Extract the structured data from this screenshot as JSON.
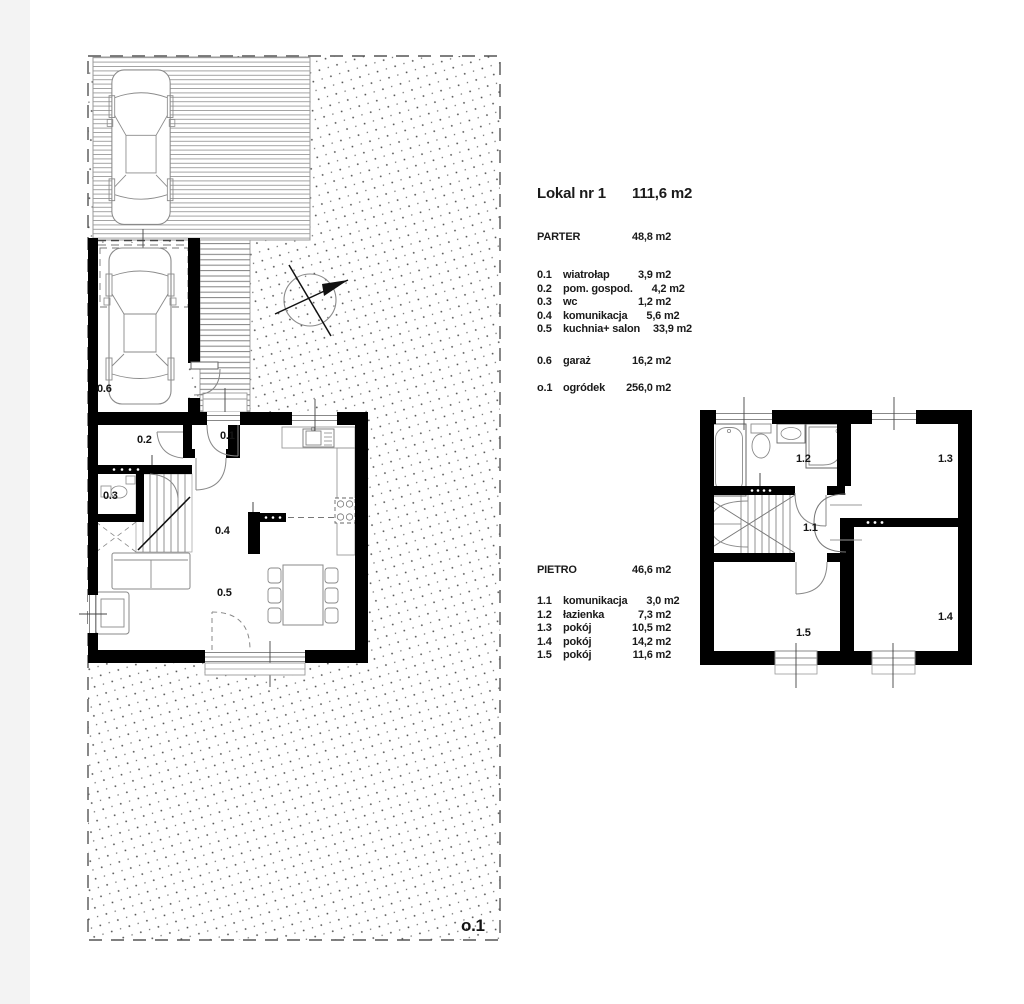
{
  "legend": {
    "title": {
      "name": "Lokal nr 1",
      "area": "111,6 m2"
    },
    "parter": {
      "label": "PARTER",
      "area": "48,8 m2",
      "items": [
        {
          "code": "0.1",
          "name": "wiatrołap",
          "area": "3,9 m2"
        },
        {
          "code": "0.2",
          "name": "pom. gospod.",
          "area": "4,2 m2"
        },
        {
          "code": "0.3",
          "name": "wc",
          "area": "1,2 m2"
        },
        {
          "code": "0.4",
          "name": "komunikacja",
          "area": "5,6 m2"
        },
        {
          "code": "0.5",
          "name": "kuchnia+ salon",
          "area": "33,9 m2"
        }
      ]
    },
    "garage_row": {
      "code": "0.6",
      "name": "garaż",
      "area": "16,2 m2"
    },
    "garden_row": {
      "code": "o.1",
      "name": "ogródek",
      "area": "256,0 m2"
    },
    "pietro": {
      "label": "PIETRO",
      "area": "46,6 m2",
      "items": [
        {
          "code": "1.1",
          "name": "komunikacja",
          "area": "3,0 m2"
        },
        {
          "code": "1.2",
          "name": "łazienka",
          "area": "7,3 m2"
        },
        {
          "code": "1.3",
          "name": "pokój",
          "area": "10,5 m2"
        },
        {
          "code": "1.4",
          "name": "pokój",
          "area": "14,2 m2"
        },
        {
          "code": "1.5",
          "name": "pokój",
          "area": "11,6 m2"
        }
      ]
    }
  },
  "plan": {
    "ground": {
      "r01": "0.1",
      "r02": "0.2",
      "r03": "0.3",
      "r04": "0.4",
      "r05": "0.5",
      "r06": "0.6",
      "garden_label": "o.1"
    },
    "upper": {
      "r11": "1.1",
      "r12": "1.2",
      "r13": "1.3",
      "r14": "1.4",
      "r15": "1.5"
    }
  },
  "colors": {
    "wall": "#000000",
    "thin_line": "#8a8a8a",
    "text": "#1a1a1a"
  }
}
